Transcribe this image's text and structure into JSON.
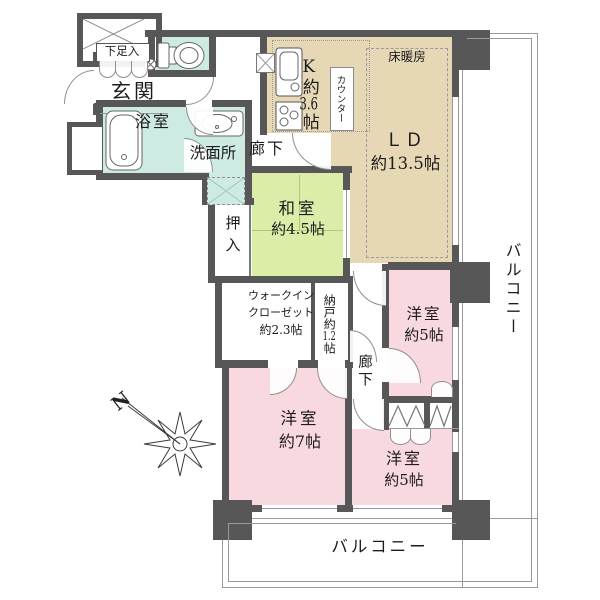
{
  "colors": {
    "wall": "#575757",
    "water_rooms": "#cdeae3",
    "ldk": "#e6d7b5",
    "tatami": "#dcedaa",
    "bedroom": "#f9d9e0",
    "line": "#999999"
  },
  "compass": {
    "label": "N"
  },
  "entry": {
    "room": "玄関",
    "shoe_cabinet": "下足入"
  },
  "sanitary": {
    "bath": "浴室",
    "wash": "洗面所"
  },
  "halls": {
    "upper": "廊下",
    "lower": "廊下"
  },
  "kitchen": {
    "prefix": "K約",
    "num": "3.6",
    "suffix": "帖",
    "counter": "カウンター"
  },
  "living": {
    "name": "ＬＤ",
    "size": "約13.5帖",
    "floor_heating": "床暖房"
  },
  "washitsu": {
    "name": "和室",
    "size": "約4.5帖",
    "closet": "押入"
  },
  "wic": {
    "line1": "ウォークイン",
    "line2": "クローゼット",
    "line3": "約2.3帖"
  },
  "nando": {
    "prefix": "納戸約",
    "num": "1.2",
    "suffix": "帖"
  },
  "bedroom5_top": {
    "name": "洋室",
    "size": "約5帖"
  },
  "bedroom7": {
    "name": "洋室",
    "size": "約7帖"
  },
  "bedroom5_bottom": {
    "name": "洋室",
    "size": "約5帖"
  },
  "balcony": {
    "right": "バルコニー",
    "bottom": "バルコニー"
  }
}
